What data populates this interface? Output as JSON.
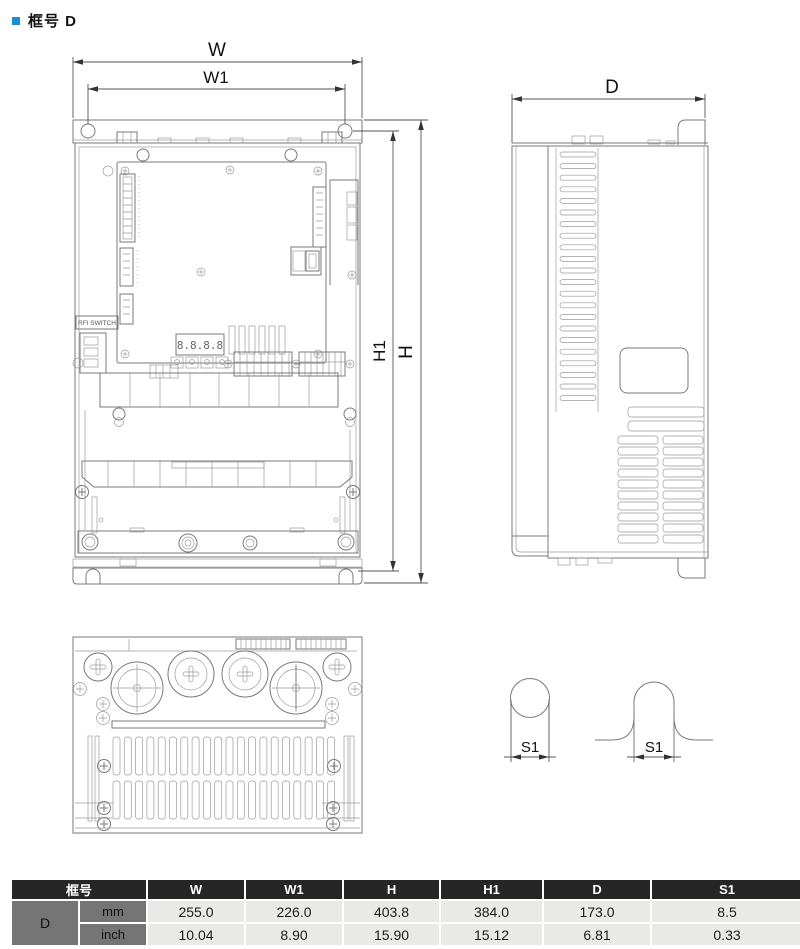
{
  "page": {
    "title": "框号 D"
  },
  "colors": {
    "accent_blue": "#1b8ed8",
    "table_header_bg": "#262626",
    "table_gray_cell": "#757575",
    "table_data_bg": "#e9e9e8",
    "drawing_line": "#7a7a7a"
  },
  "drawing": {
    "dims": {
      "w": "W",
      "w1": "W1",
      "h": "H",
      "h1": "H1",
      "d": "D",
      "s1_round": "S1",
      "s1_slot": "S1"
    },
    "front_view": {
      "rfi_label": "RFI SWITCH",
      "display_text": "8.8.8.8"
    }
  },
  "table": {
    "frame_header": "框号",
    "columns": [
      "W",
      "W1",
      "H",
      "H1",
      "D",
      "S1"
    ],
    "rows": [
      {
        "frame": "D",
        "unit": "mm",
        "values": [
          "255.0",
          "226.0",
          "403.8",
          "384.0",
          "173.0",
          "8.5"
        ]
      },
      {
        "unit": "inch",
        "values": [
          "10.04",
          "8.90",
          "15.90",
          "15.12",
          "6.81",
          "0.33"
        ]
      }
    ]
  }
}
